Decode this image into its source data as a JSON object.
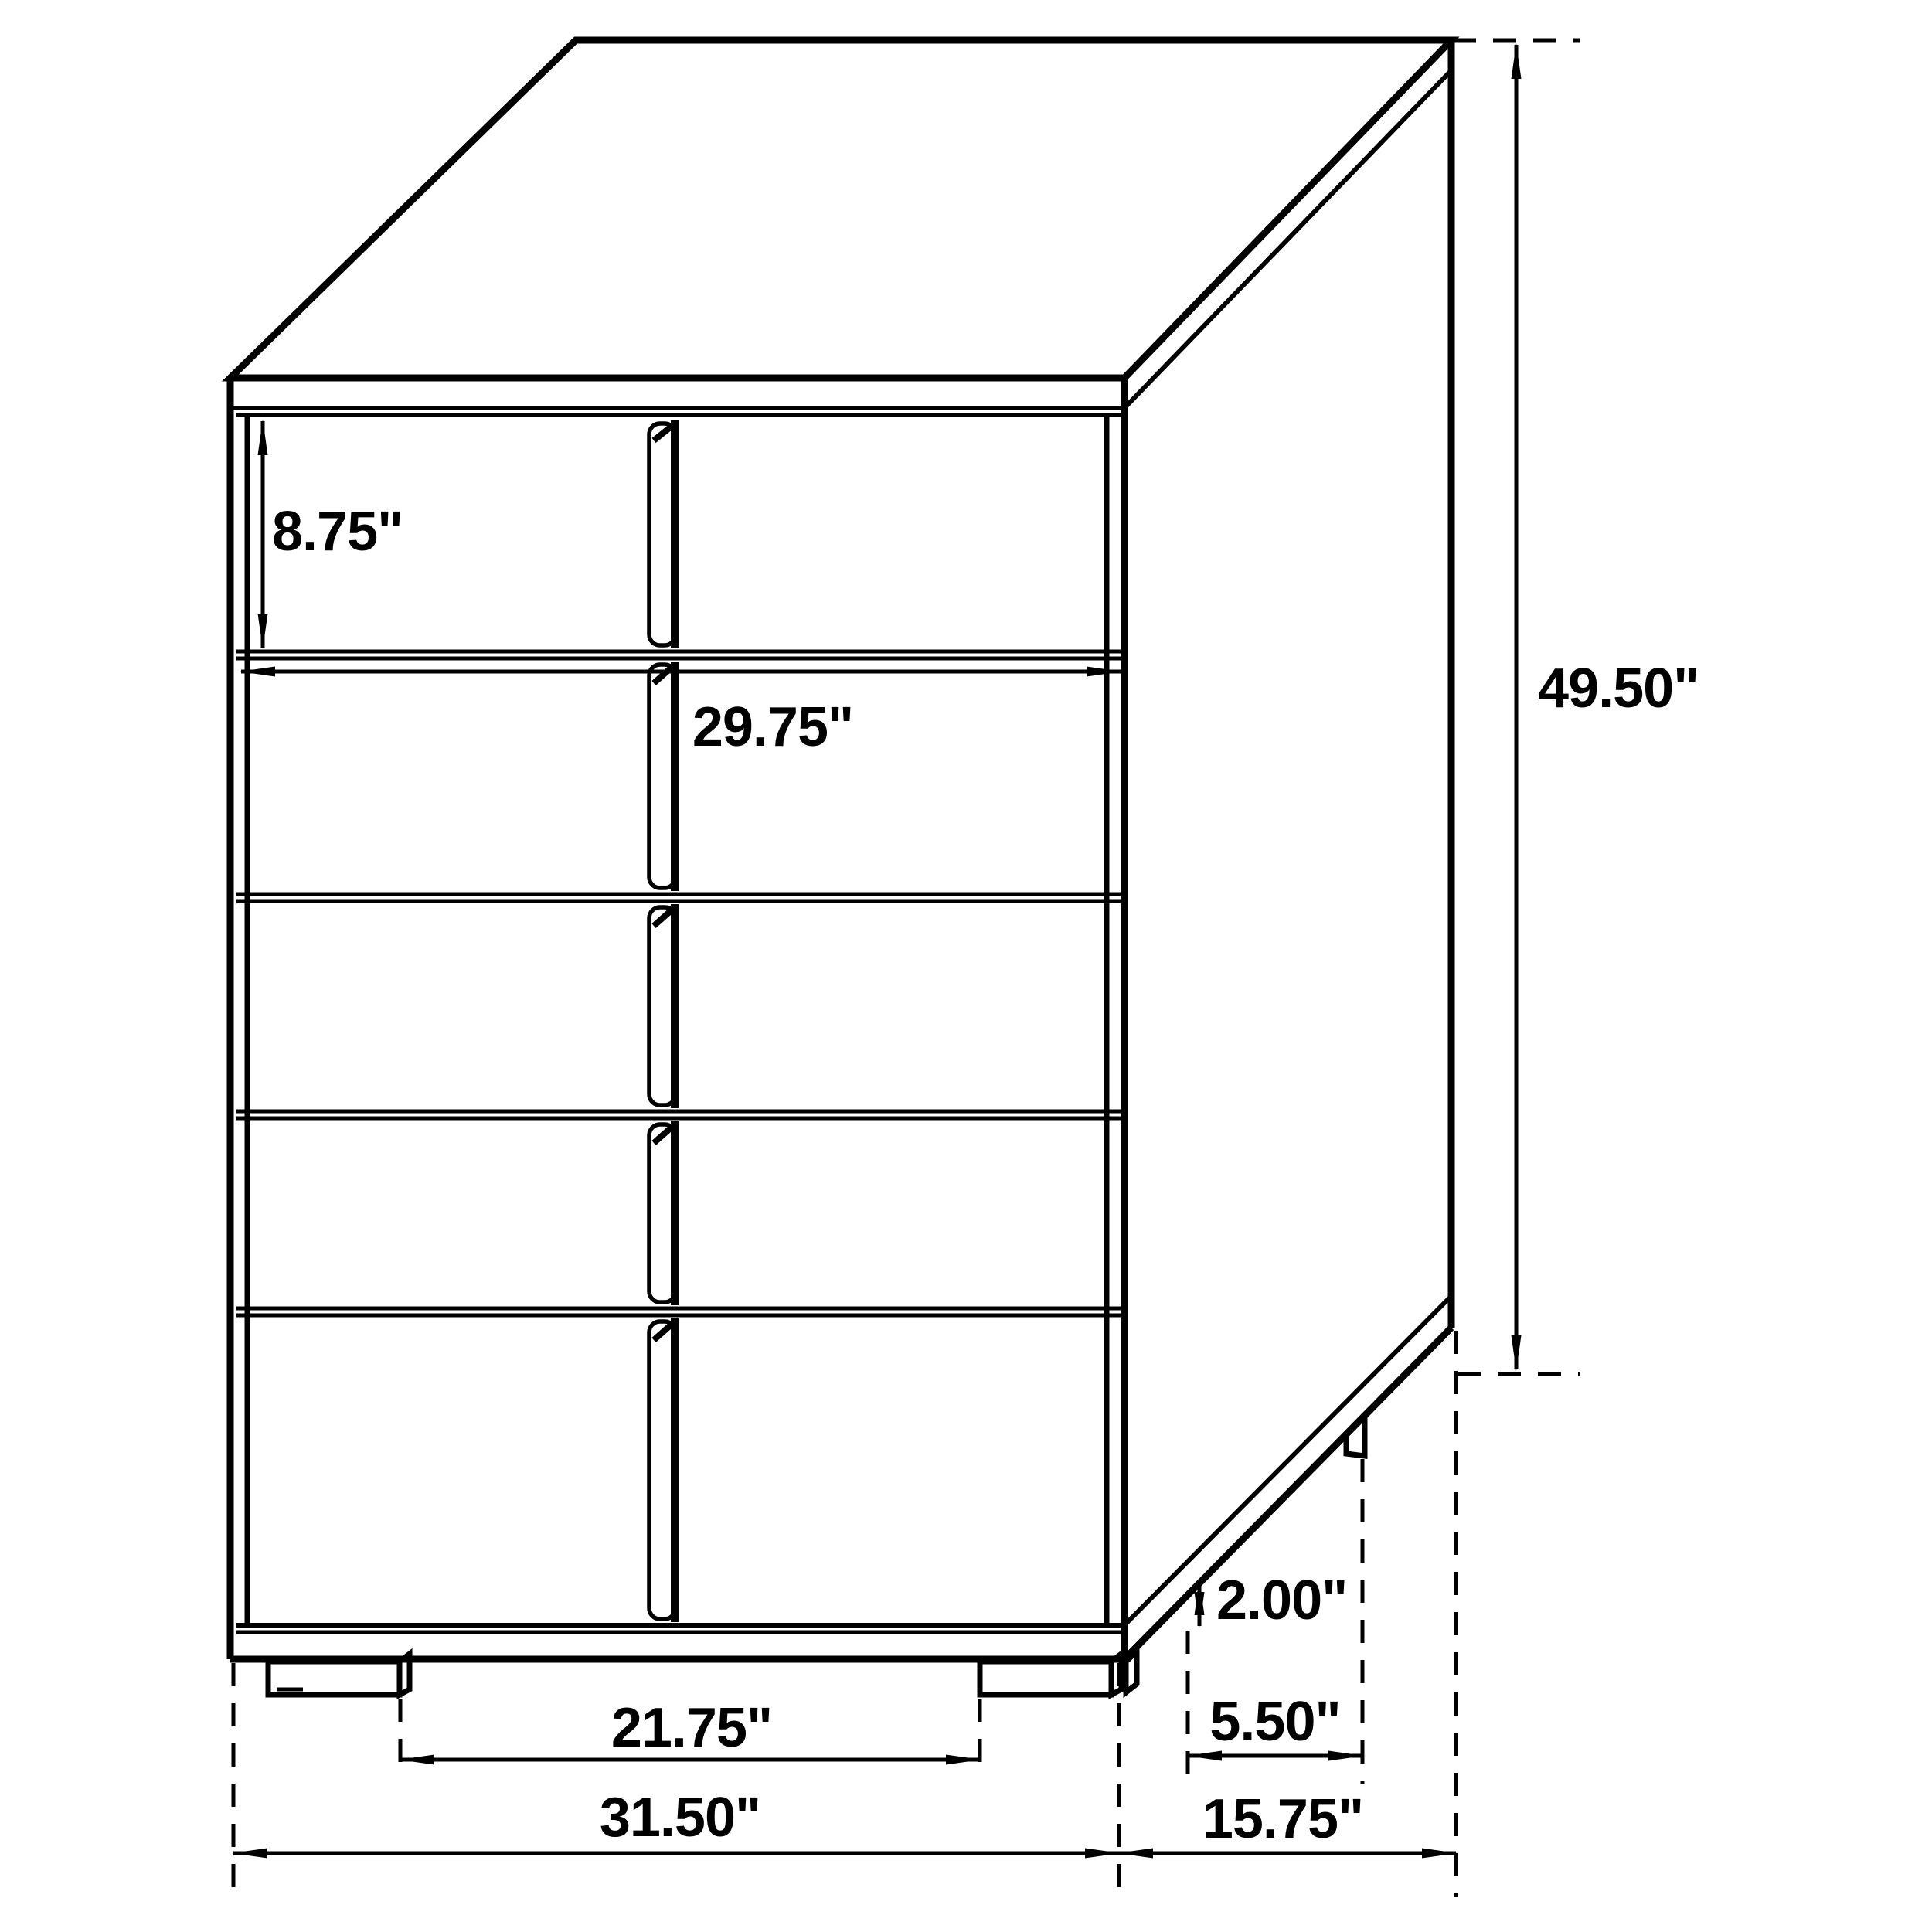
{
  "diagram": {
    "type": "furniture-dimension-drawing",
    "subject": "five-drawer-chest-isometric-outline",
    "colors": {
      "line": "#000000",
      "background": "#ffffff"
    },
    "labels": {
      "drawer_height": "8.75\"",
      "drawer_width": "29.75\"",
      "overall_height": "49.50\"",
      "foot_height": "2.00\"",
      "side_foot_spacing": "5.50\"",
      "front_foot_spacing": "21.75\"",
      "overall_width": "31.50\"",
      "overall_depth": "15.75\""
    }
  }
}
